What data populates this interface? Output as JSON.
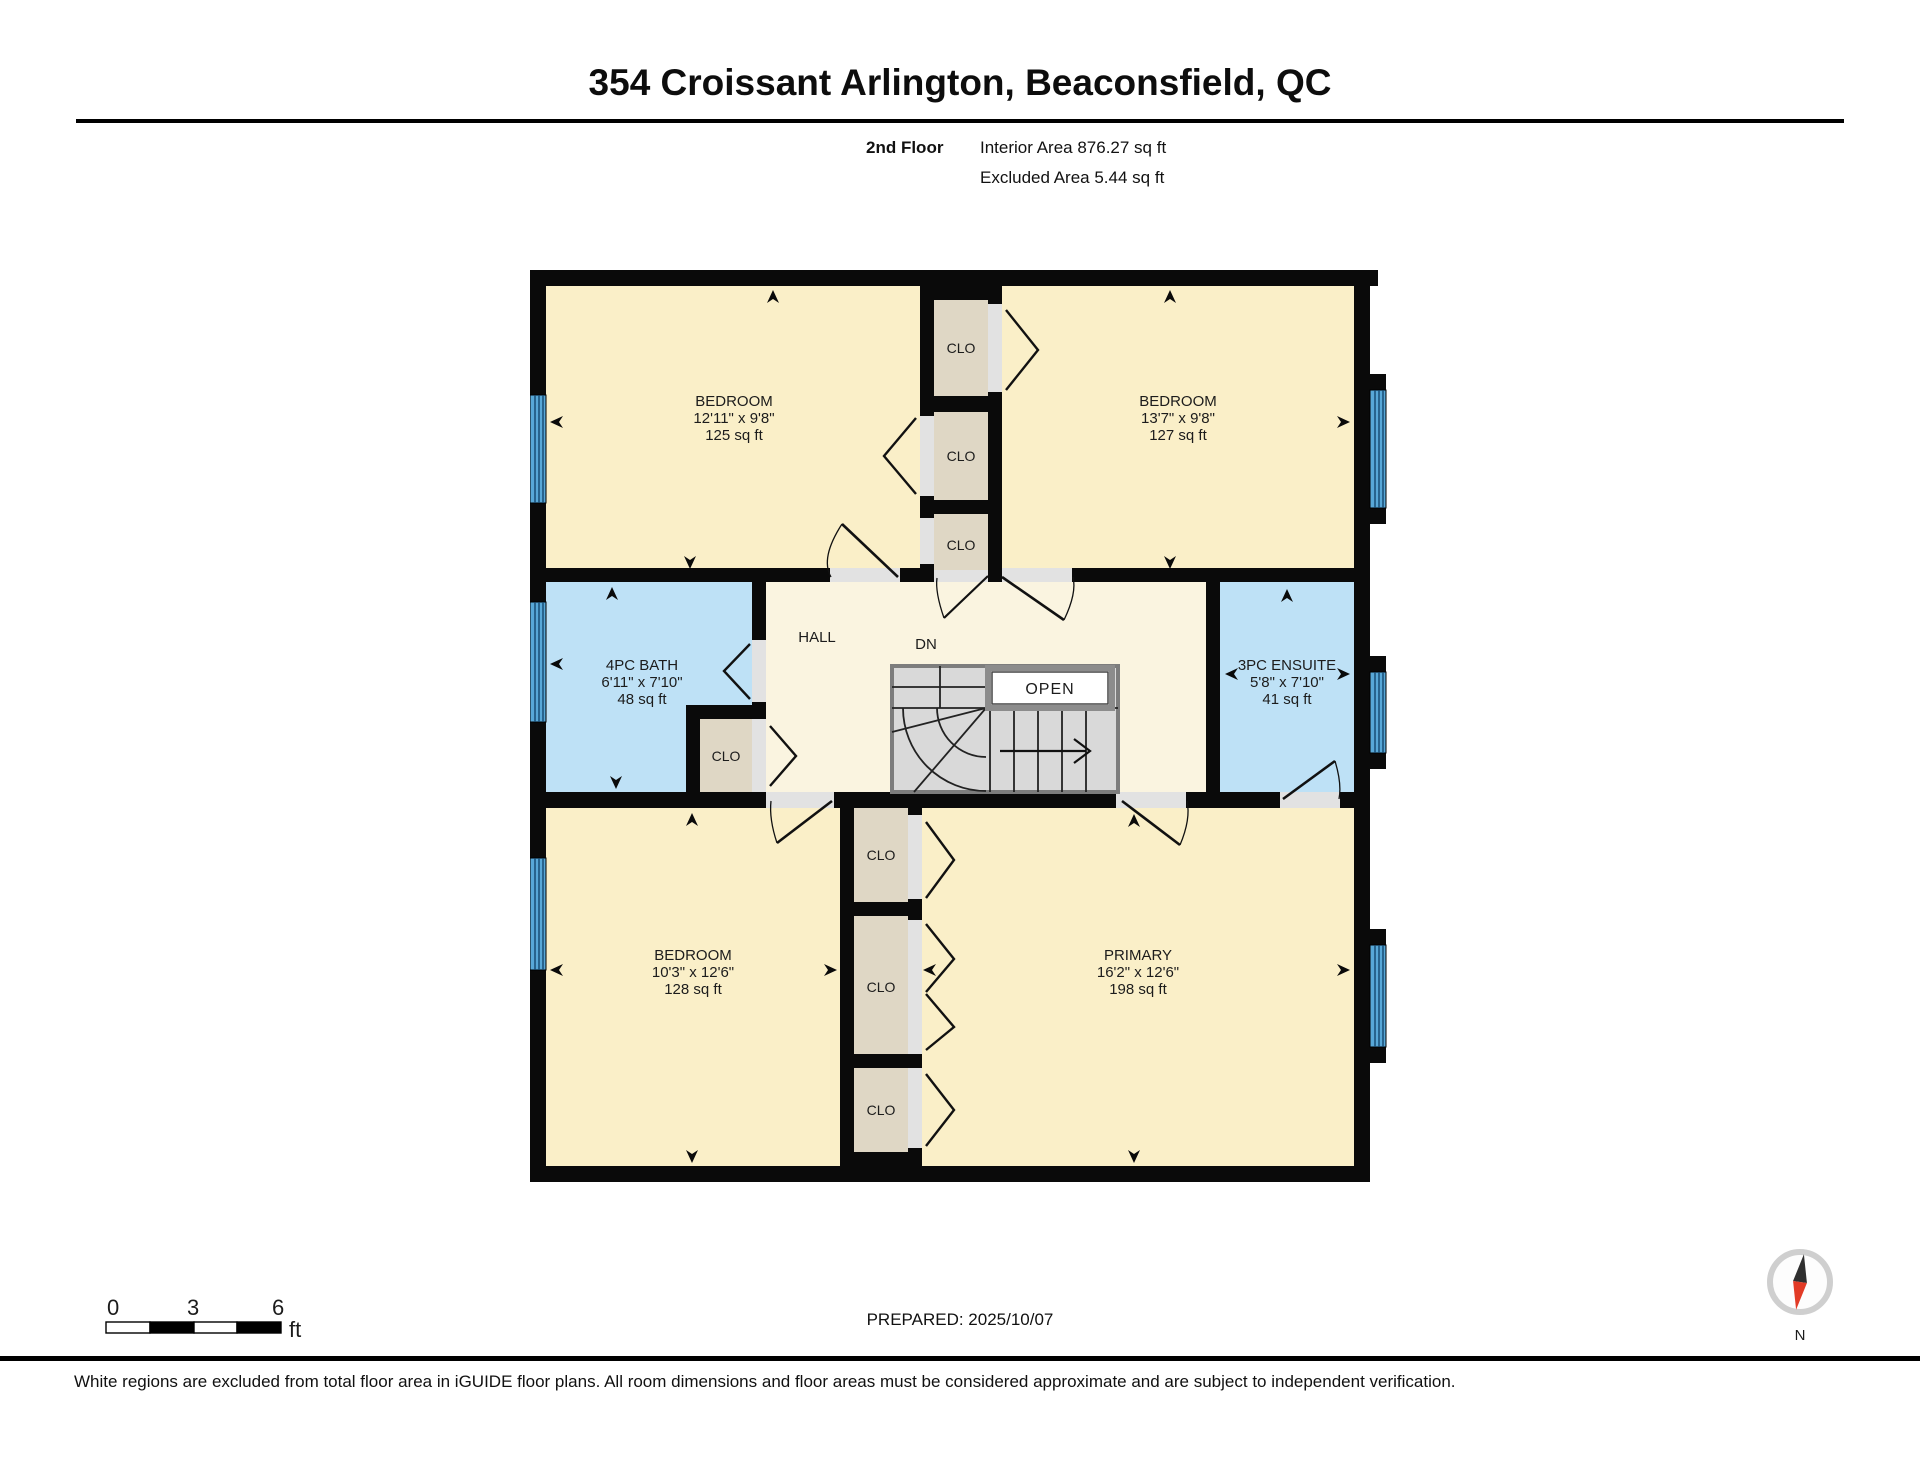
{
  "header": {
    "title": "354 Croissant Arlington, Beaconsfield, QC",
    "floor": "2nd Floor",
    "interior_area": "Interior Area 876.27 sq ft",
    "excluded_area": "Excluded Area 5.44 sq ft"
  },
  "rooms": {
    "bedroom_tl": {
      "name": "BEDROOM",
      "dims": "12'11\" x 9'8\"",
      "area": "125 sq ft"
    },
    "bedroom_tr": {
      "name": "BEDROOM",
      "dims": "13'7\" x 9'8\"",
      "area": "127 sq ft"
    },
    "bath": {
      "name": "4PC BATH",
      "dims": "6'11\" x 7'10\"",
      "area": "48 sq ft"
    },
    "hall": {
      "name": "HALL"
    },
    "ensuite": {
      "name": "3PC ENSUITE",
      "dims": "5'8\" x 7'10\"",
      "area": "41 sq ft"
    },
    "bedroom_bl": {
      "name": "BEDROOM",
      "dims": "10'3\" x 12'6\"",
      "area": "128 sq ft"
    },
    "primary": {
      "name": "PRIMARY",
      "dims": "16'2\" x 12'6\"",
      "area": "198 sq ft"
    }
  },
  "labels": {
    "closet": "CLO",
    "down": "DN",
    "open": "OPEN",
    "north": "N"
  },
  "scale_bar": {
    "tick0": "0",
    "tick1": "3",
    "tick2": "6",
    "unit": "ft"
  },
  "footer": {
    "prepared": "PREPARED: 2025/10/07",
    "disclaimer": "White regions are excluded from total floor area in iGUIDE floor plans. All room dimensions and floor areas must be considered approximate and are subject to independent verification."
  },
  "colors": {
    "wall": "#0a0a0a",
    "room_cream": "#faefc8",
    "hall_cream": "#faf4e0",
    "closet_tan": "#dfd7c5",
    "wet_room_blue": "#bee1f6",
    "window_blue": "#58a8d8",
    "stair_gray": "#d9d9d9",
    "door_swing_gray": "#e2e2e2",
    "compass_red": "#e23b26"
  }
}
